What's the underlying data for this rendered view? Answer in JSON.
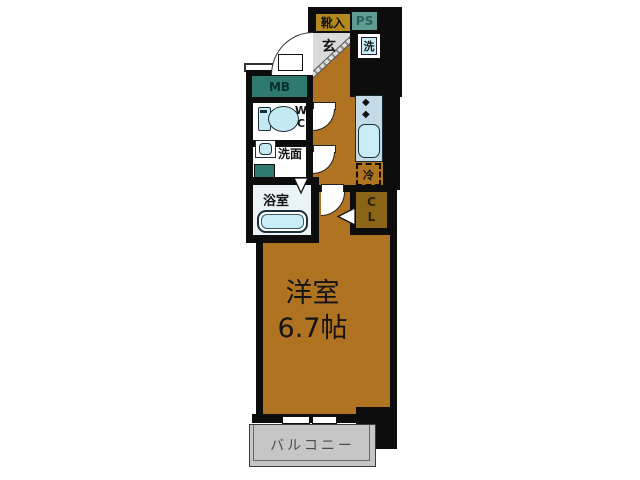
{
  "floorplan": {
    "type": "apartment-floor-plan",
    "labels": {
      "shoe_cabinet": "靴入",
      "pipe_space": "PS",
      "entrance": "玄",
      "washer": "洗",
      "meter_box": "MB",
      "wc_line1": "W",
      "wc_line2": "C",
      "washroom": "洗面",
      "bathroom": "浴室",
      "refrigerator": "冷",
      "closet_line1": "C",
      "closet_line2": "L",
      "room_name": "洋室",
      "room_size": "6.7帖",
      "balcony": "バルコニー"
    },
    "icons": {
      "stove_burner": "◆"
    },
    "colors": {
      "floor": "#af7321",
      "shoe_cabinet": "#b4891d",
      "meter_box_teal": "#2e7a6e",
      "pipe_space_teal": "#5e9c94",
      "fixture_blue": "#c9edf6",
      "kitchen_counter": "#c3dae8",
      "bathroom_floor": "#e9f3f8",
      "closet_brown": "#8a6417",
      "genkan_gray": "#dadada",
      "balcony_gray": "#c6c6c6",
      "wall": "#0d0d0d"
    }
  }
}
